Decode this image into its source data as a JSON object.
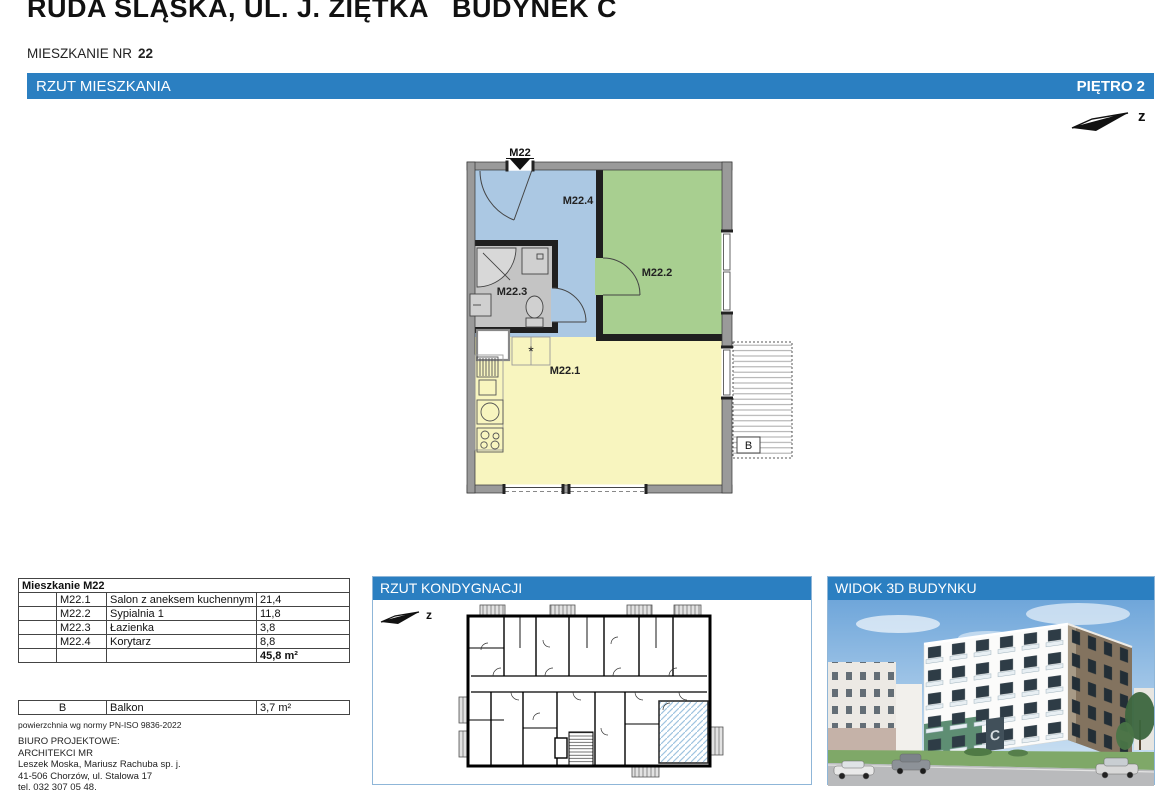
{
  "page": {
    "title": "RUDA ŚLĄSKA, UL. J. ZIĘTKA   BUDYNEK C",
    "apartment_label": "MIESZKANIE NR",
    "apartment_number": "22"
  },
  "bars": {
    "plan_left": "RZUT MIESZKANIA",
    "plan_right": "PIĘTRO 2"
  },
  "north": {
    "label": "z"
  },
  "plan": {
    "entrance": "M22",
    "rooms": {
      "living": "M22.1",
      "bedroom": "M22.2",
      "bath": "M22.3",
      "hall": "M22.4"
    },
    "balcony": "B",
    "symbol": "*"
  },
  "area_table": {
    "title": "Mieszkanie M22",
    "rows": [
      {
        "code": "M22.1",
        "name": "Salon z aneksem kuchennym",
        "area": "21,4"
      },
      {
        "code": "M22.2",
        "name": "Sypialnia 1",
        "area": "11,8"
      },
      {
        "code": "M22.3",
        "name": "Łazienka",
        "area": "3,8"
      },
      {
        "code": "M22.4",
        "name": "Korytarz",
        "area": "8,8"
      }
    ],
    "total": "45,8 m²"
  },
  "balcony_table": {
    "code": "B",
    "name": "Balkon",
    "area": "3,7 m²"
  },
  "notes": {
    "norm": "powierzchnia wg normy PN-ISO 9836-2022"
  },
  "office": {
    "heading": "BIURO PROJEKTOWE:",
    "name": "ARCHITEKCI MR",
    "partners": "Leszek Moska, Mariusz Rachuba sp. j.",
    "address": "41-506 Chorzów, ul. Stalowa 17",
    "phone": "tel. 032 307 05 48."
  },
  "panels": {
    "floor_title": "RZUT KONDYGNACJI",
    "view3d_title": "WIDOK 3D BUDYNKU"
  },
  "view3d": {
    "building_letter": "C"
  },
  "colors": {
    "accent_blue": "#2b7fc1",
    "hall_blue": "#abc8e3",
    "bedroom_green": "#a8cf90",
    "living_yellow": "#f8f5bf",
    "bath_gray": "#c4c4c4",
    "wall_gray": "#9a9a9a",
    "highlight_hatch": "#9fc4e0"
  }
}
